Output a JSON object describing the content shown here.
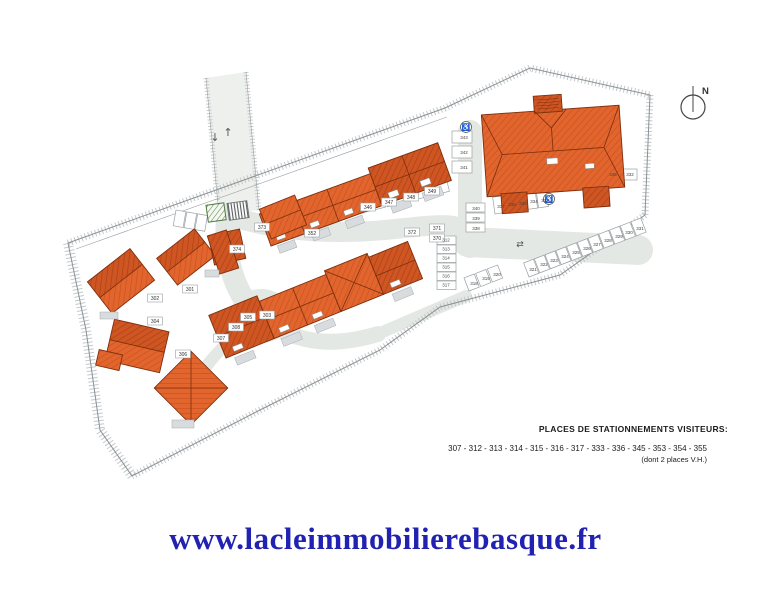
{
  "plan": {
    "compass_label": "N",
    "arrow_up": "↑",
    "arrow_down": "↓",
    "two_way_arrow": "⇄",
    "accessible_symbol": "♿",
    "colors": {
      "roof_orange": "#e2652e",
      "roof_dark": "#cf5522",
      "road_gray": "#e4e8e4"
    },
    "labels": [
      "301",
      "302",
      "303",
      "304",
      "305",
      "306",
      "307",
      "308",
      "352",
      "370",
      "371",
      "372",
      "373",
      "374",
      "312",
      "313",
      "314",
      "315",
      "316",
      "317",
      "318",
      "319",
      "320",
      "321",
      "322",
      "323",
      "324",
      "325",
      "326",
      "327",
      "328",
      "329",
      "330",
      "331",
      "343",
      "342",
      "341",
      "345",
      "332",
      "340",
      "339",
      "338",
      "337",
      "336",
      "335",
      "334",
      "333",
      "346",
      "347",
      "348",
      "349"
    ]
  },
  "legend": {
    "title": "PLACES DE STATIONNEMENTS VISITEURS:",
    "numbers": "307 - 312 - 313 - 314 - 315 - 316 - 317 - 333 - 336 - 345 - 353 - 354 - 355",
    "note": "(dont 2 places V.H.)"
  },
  "footer": {
    "url": "www.lacleimmobilierebasque.fr",
    "url_color": "#2222b2"
  }
}
